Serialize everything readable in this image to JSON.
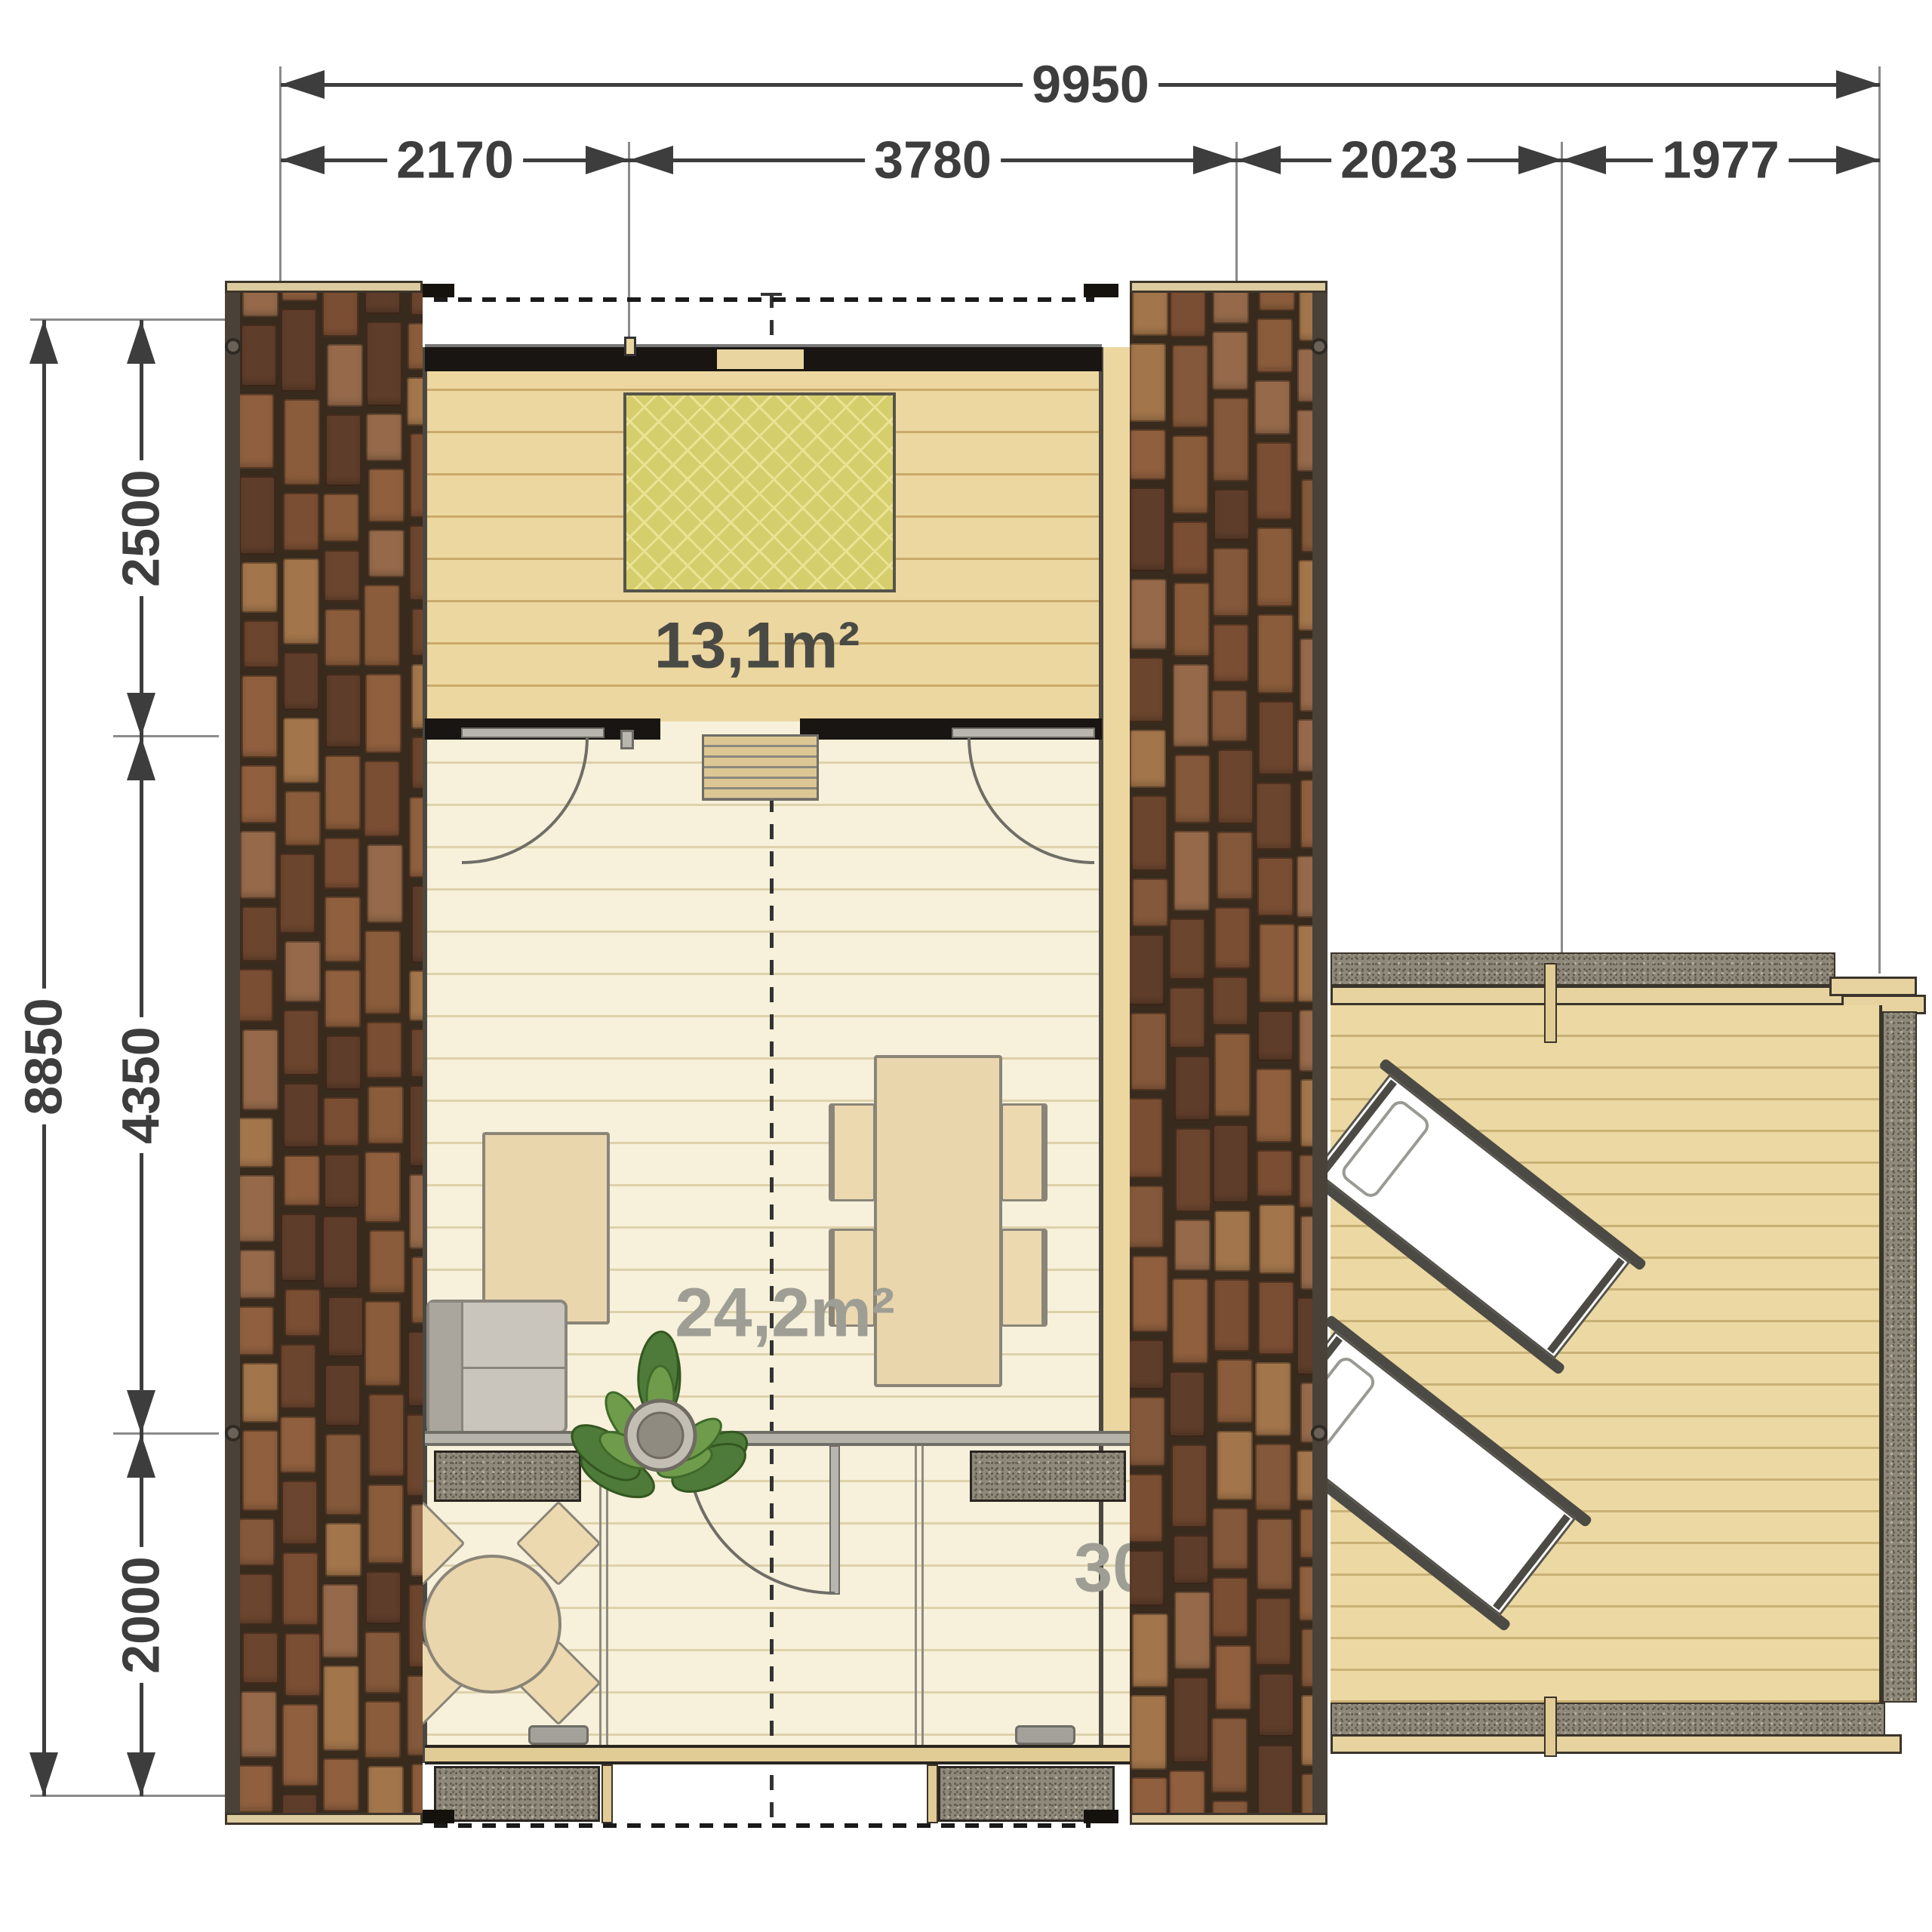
{
  "drawing": {
    "type": "cabin floor plan",
    "dimensions": {
      "top": {
        "total": "9950",
        "segments": [
          "2170",
          "3780",
          "2023",
          "1977"
        ]
      },
      "left": {
        "total": "8850",
        "segments": [
          "2500",
          "4350",
          "2000"
        ]
      }
    },
    "areas": {
      "bedroom": "13,1m²",
      "living": "24,2m²",
      "total": "30,0m²"
    },
    "colors": {
      "dimension": "#3d3d3d",
      "brick": "#84583a",
      "wall": "#181512",
      "bedroom_floor": "#ecd7a0",
      "living_floor": "#f7f0da",
      "rug": "#d5ce6c",
      "deck_floor": "#ebd8a2",
      "granite": "#8f897c",
      "area_label_dark": "#4a4a45",
      "area_label_gray": "#9e9e95"
    }
  }
}
